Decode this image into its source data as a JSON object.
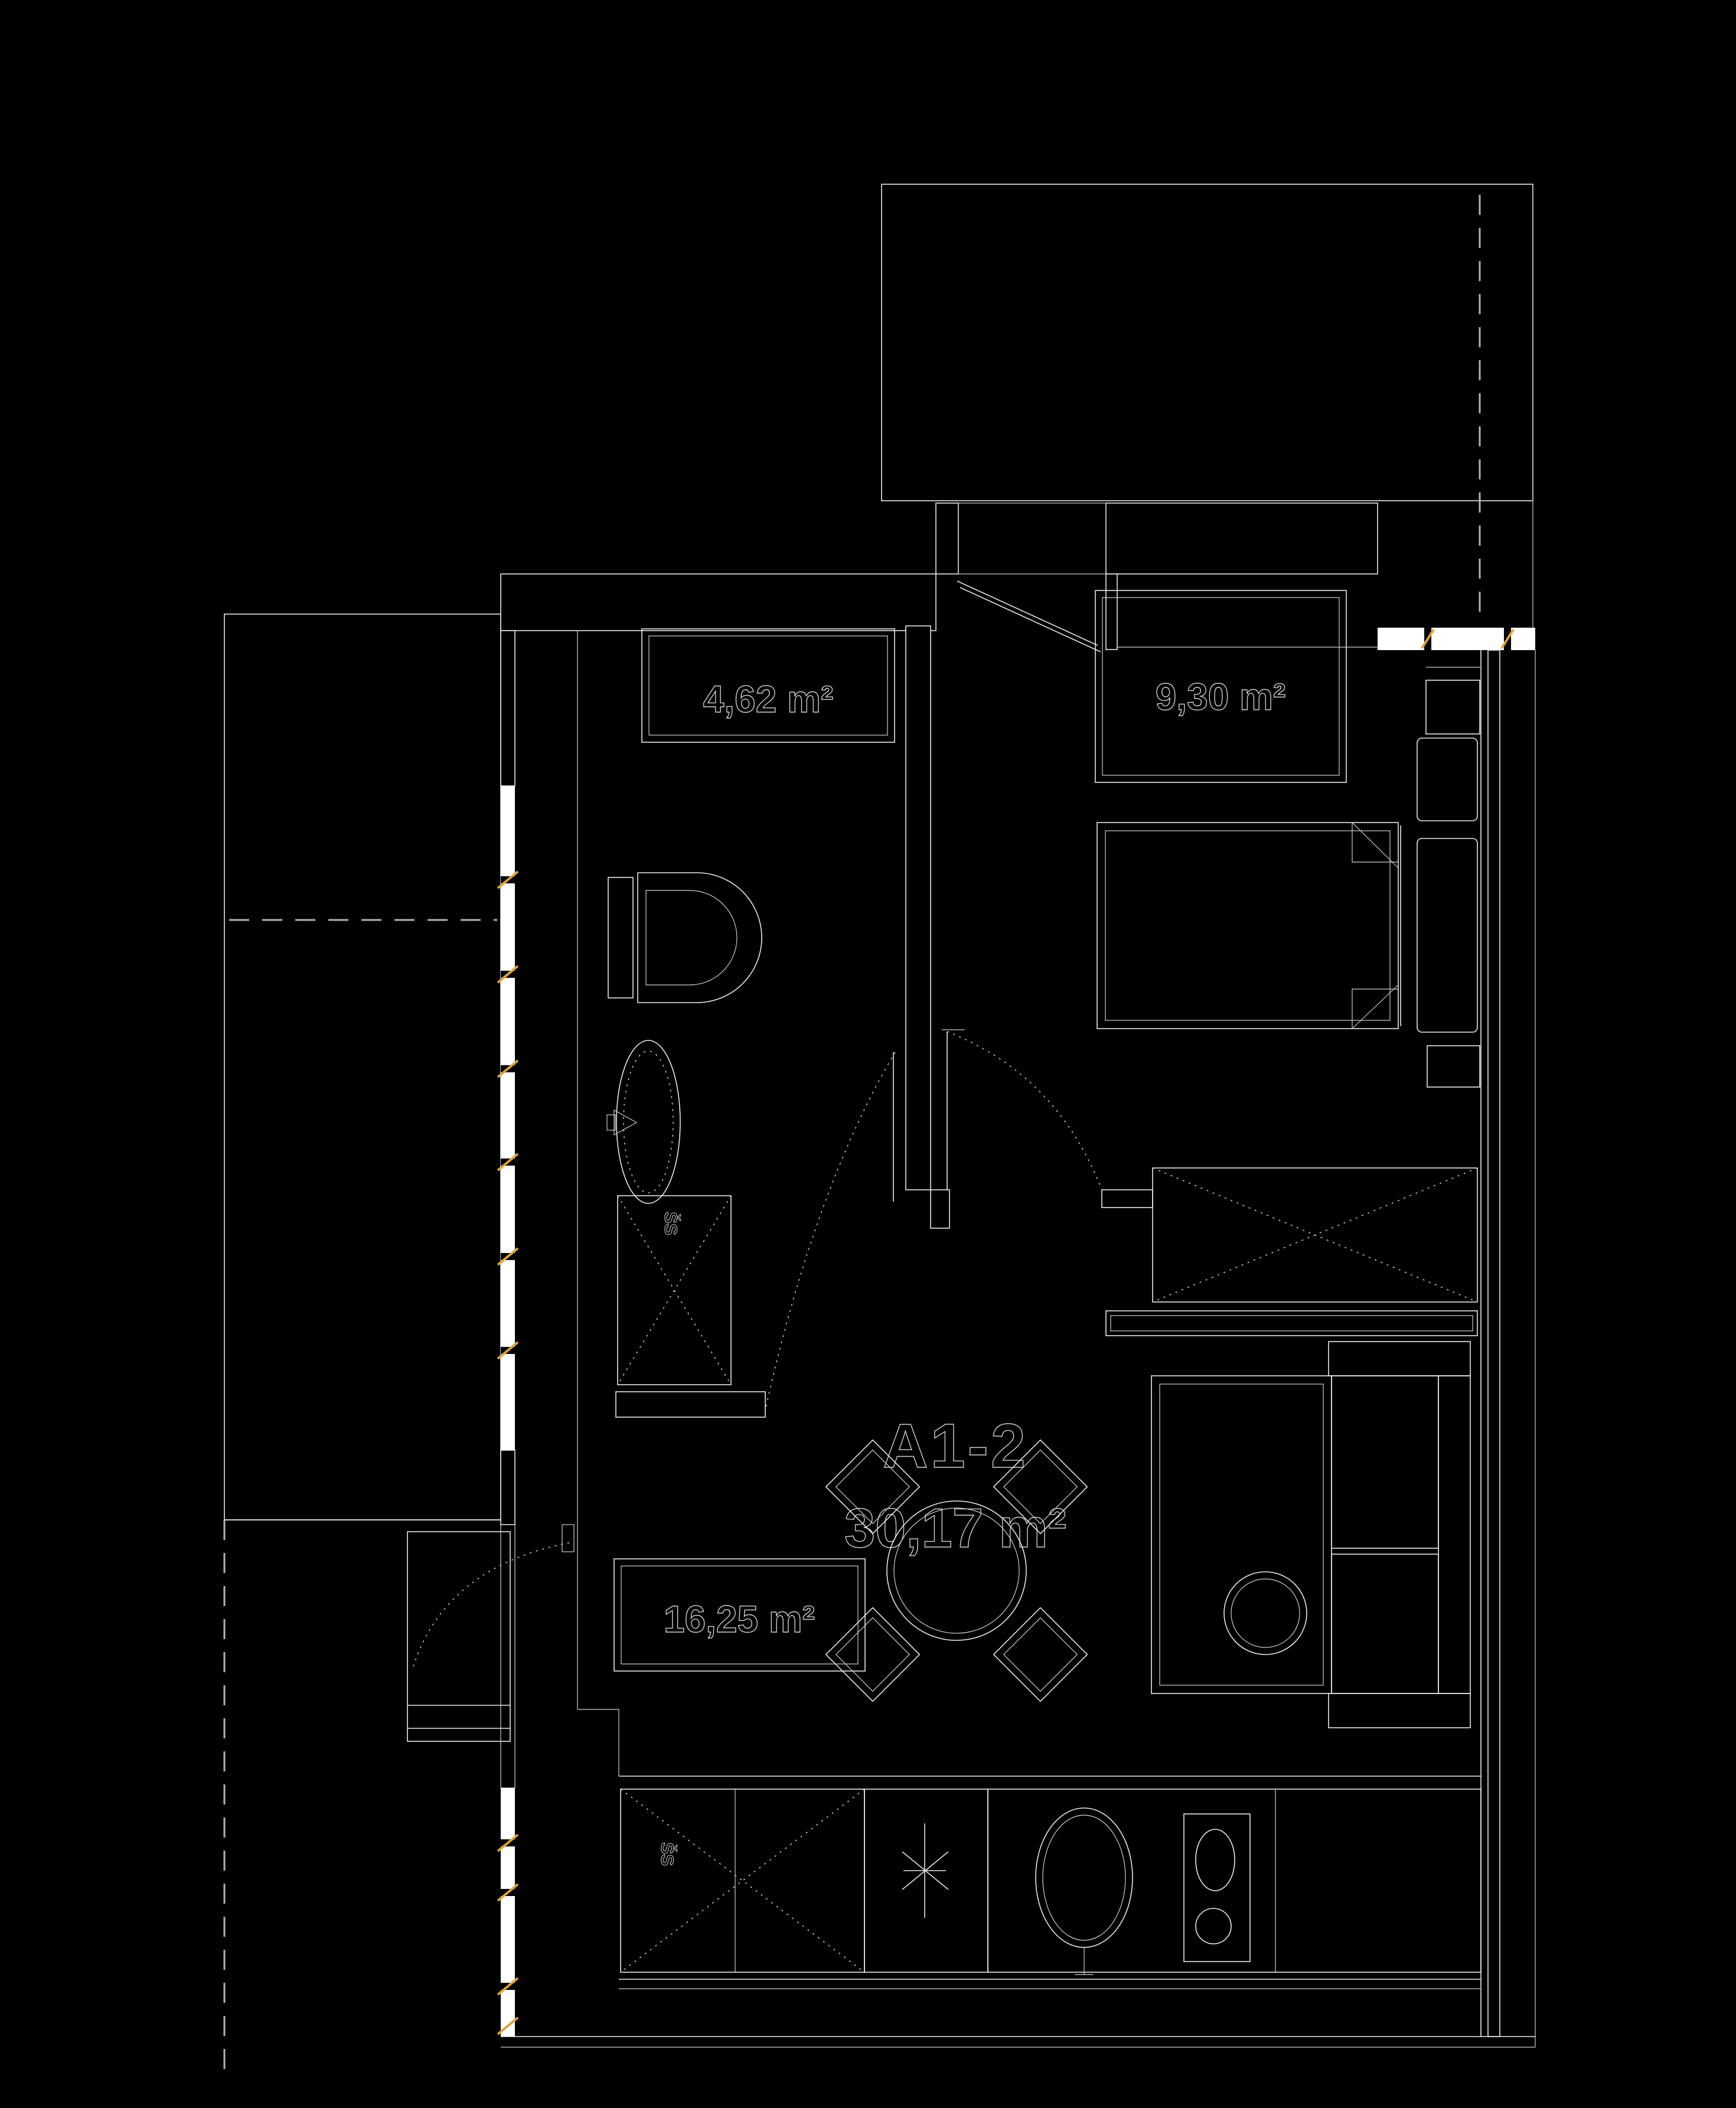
{
  "unit": {
    "id": "A1-2",
    "total_area": "30,17 m²"
  },
  "rooms": [
    {
      "name": "bathroom",
      "area_label": "4,62 m²"
    },
    {
      "name": "bedroom",
      "area_label": "9,30 m²"
    },
    {
      "name": "living-kitchen",
      "area_label": "16,25 m²"
    }
  ],
  "annotations": {
    "closet_mark": "ŠS",
    "shower_mark": "ŠS"
  },
  "colors": {
    "background": "#000000",
    "line": "#e9e9e9",
    "dim_line": "#b5b5b5",
    "window_fill": "#ffffff",
    "accent_yellow": "#dfa437",
    "text_outline": "#cfcfcf"
  }
}
